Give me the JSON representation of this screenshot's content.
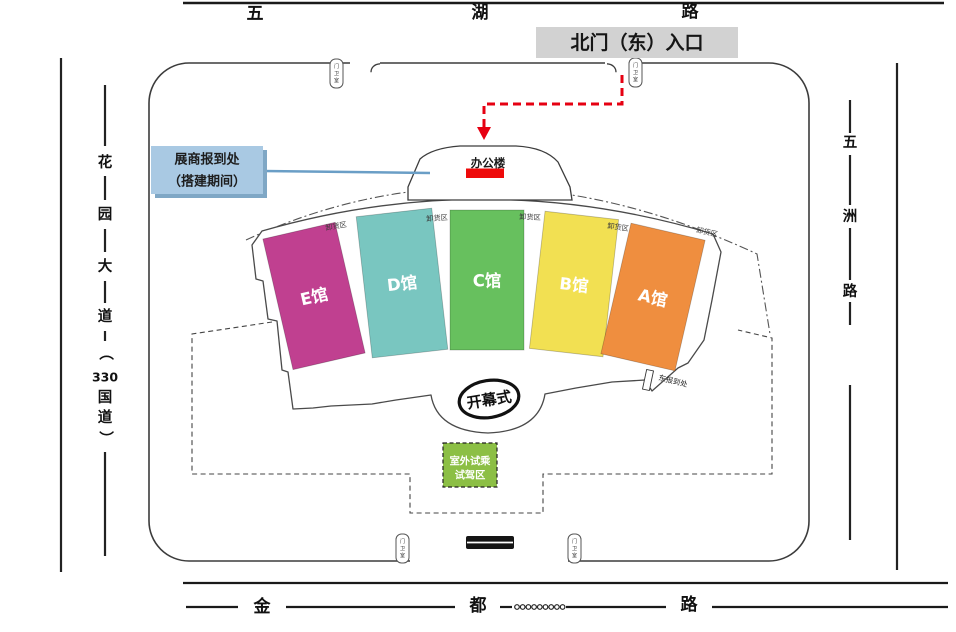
{
  "roads": {
    "top": {
      "name": "五湖路",
      "chars": [
        "五",
        "湖",
        "路"
      ]
    },
    "bottom": {
      "name": "金都路",
      "chars": [
        "金",
        "都",
        "路"
      ]
    },
    "left": {
      "name": "花园大道（330国道）",
      "chars": [
        "花",
        "园",
        "大",
        "道",
        "（",
        "330",
        "国",
        "道",
        "）"
      ]
    },
    "right": {
      "name": "五洲路",
      "chars": [
        "五",
        "洲",
        "路"
      ]
    }
  },
  "entrance": {
    "north_gate_label": "北门（东）入口"
  },
  "annotations": {
    "exhibitor_checkin": {
      "line1": "展商报到处",
      "line2": "（搭建期间）"
    },
    "office_building": "办公楼",
    "opening_ceremony": "开幕式",
    "outdoor_test_drive": {
      "line1": "室外试乘",
      "line2": "试驾区"
    },
    "east_checkin": "东报到处",
    "unloading_area": "卸货区",
    "gate_house_chars": [
      "门",
      "卫",
      "室"
    ]
  },
  "halls": [
    {
      "id": "A",
      "label": "A馆",
      "color": "#ef8e3f"
    },
    {
      "id": "B",
      "label": "B馆",
      "color": "#f2e052"
    },
    {
      "id": "C",
      "label": "C馆",
      "color": "#67c05e"
    },
    {
      "id": "D",
      "label": "D馆",
      "color": "#79c6c0"
    },
    {
      "id": "E",
      "label": "E馆",
      "color": "#c04090"
    }
  ],
  "colors": {
    "red_route": "#e60012",
    "office_marker_red": "#ee0a0a",
    "north_gate_bg": "#d2d2d2",
    "checkin_label_bg": "#a9c9e3",
    "checkin_label_shadow": "#7fa7c5",
    "checkin_pointer_line": "#6a9ec6",
    "test_drive_bg": "#8cbf45"
  }
}
